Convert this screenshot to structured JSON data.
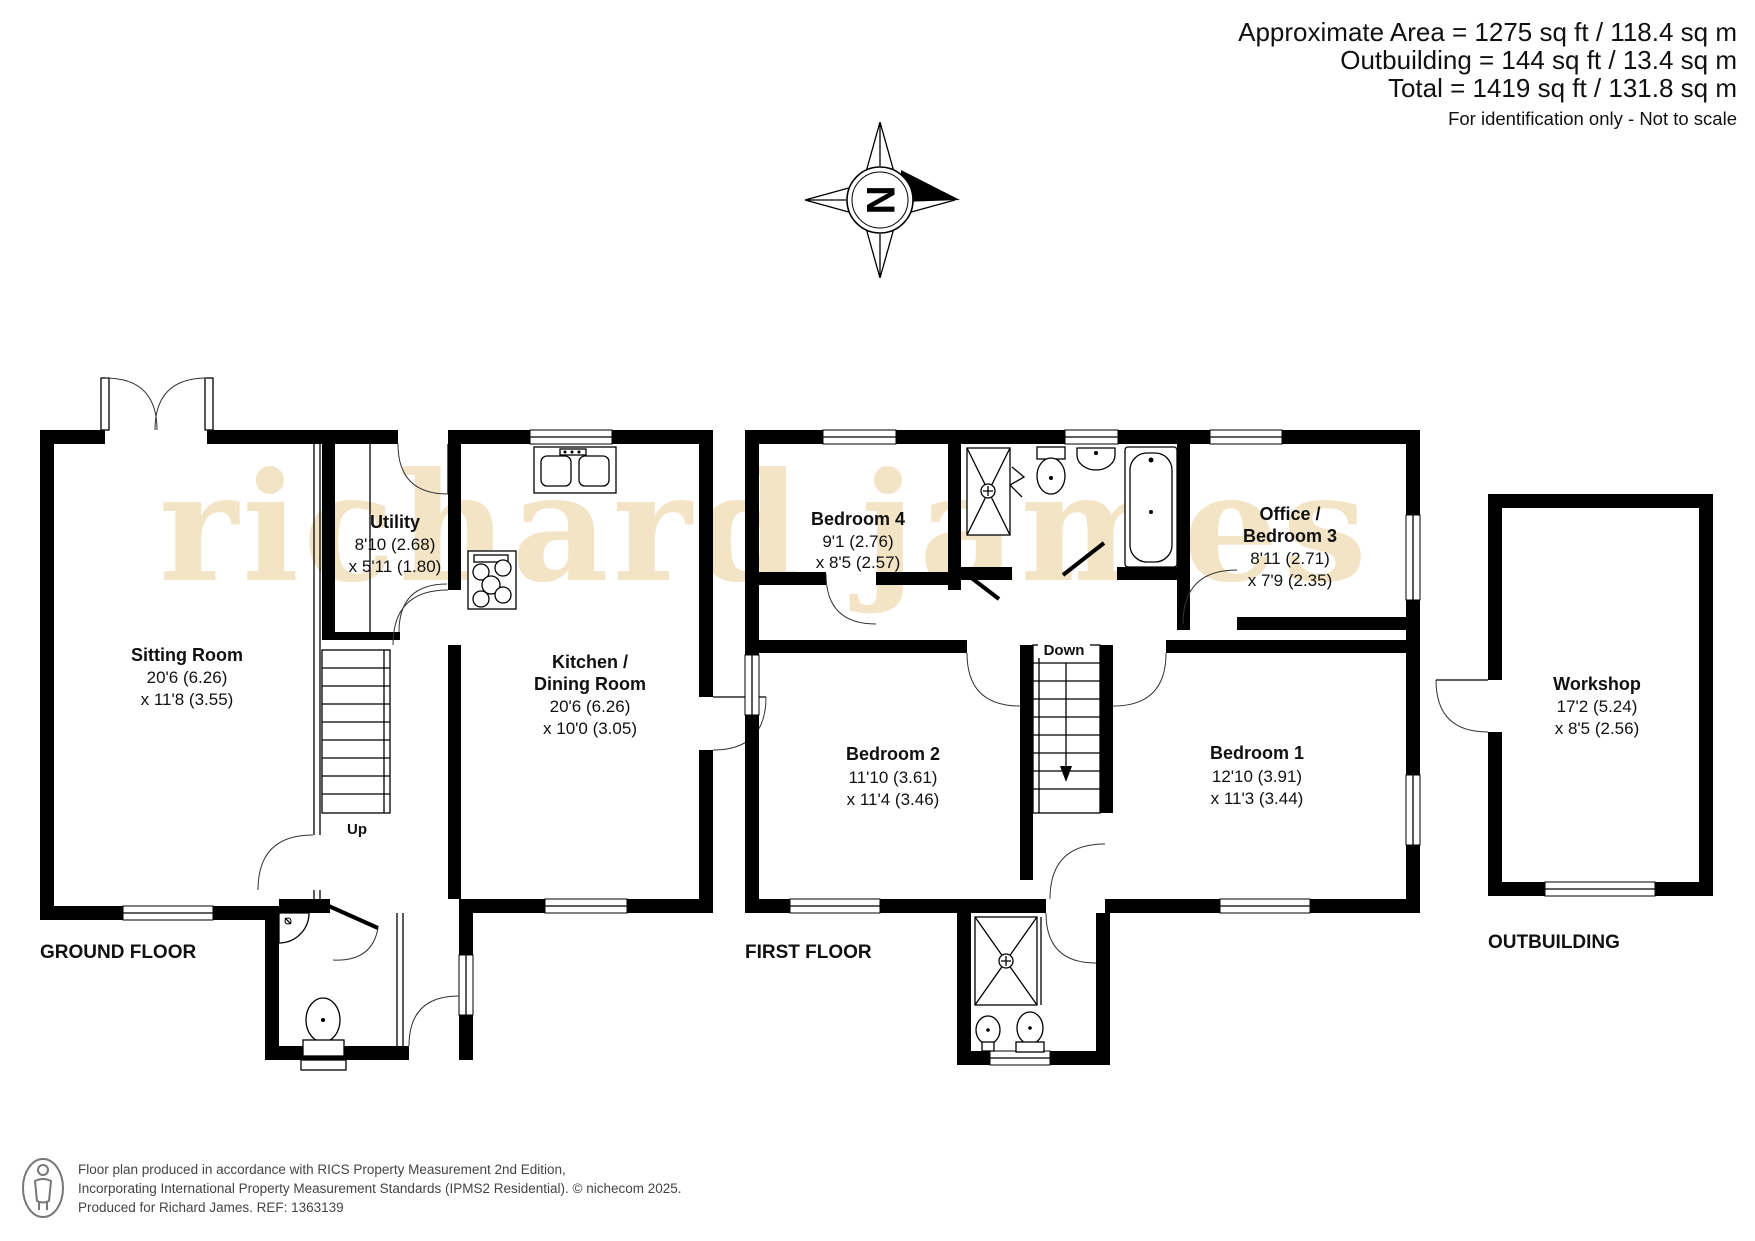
{
  "header": {
    "line1": "Approximate Area = 1275 sq ft / 118.4 sq m",
    "line2": "Outbuilding = 144 sq ft / 13.4 sq m",
    "line3": "Total = 1419 sq ft / 131.8 sq m",
    "line4": "For identification only - Not to scale"
  },
  "compass": {
    "letter": "N"
  },
  "watermark": {
    "text": "richard james",
    "color": "#f4e4c6"
  },
  "floor_labels": {
    "ground": "GROUND FLOOR",
    "first": "FIRST FLOOR",
    "outbuilding": "OUTBUILDING"
  },
  "stairs": {
    "up": "Up",
    "down": "Down"
  },
  "rooms": {
    "sitting": {
      "name": "Sitting Room",
      "dim1": "20'6 (6.26)",
      "dim2": "x 11'8 (3.55)"
    },
    "utility": {
      "name": "Utility",
      "dim1": "8'10 (2.68)",
      "dim2": "x 5'11 (1.80)"
    },
    "kitchen": {
      "name": "Kitchen /",
      "name2": "Dining Room",
      "dim1": "20'6 (6.26)",
      "dim2": "x 10'0 (3.05)"
    },
    "bedroom4": {
      "name": "Bedroom 4",
      "dim1": "9'1 (2.76)",
      "dim2": "x 8'5 (2.57)"
    },
    "office": {
      "name": "Office /",
      "name2": "Bedroom 3",
      "dim1": "8'11 (2.71)",
      "dim2": "x 7'9 (2.35)"
    },
    "bedroom2": {
      "name": "Bedroom 2",
      "dim1": "11'10 (3.61)",
      "dim2": "x 11'4 (3.46)"
    },
    "bedroom1": {
      "name": "Bedroom 1",
      "dim1": "12'10 (3.91)",
      "dim2": "x 11'3 (3.44)"
    },
    "workshop": {
      "name": "Workshop",
      "dim1": "17'2 (5.24)",
      "dim2": "x 8'5 (2.56)"
    }
  },
  "footer": {
    "line1": "Floor plan produced in accordance with RICS Property Measurement 2nd Edition,",
    "line2": "Incorporating International Property Measurement Standards (IPMS2 Residential).   © nichecom 2025.",
    "line3": "Produced for Richard James.   REF:  1363139"
  }
}
